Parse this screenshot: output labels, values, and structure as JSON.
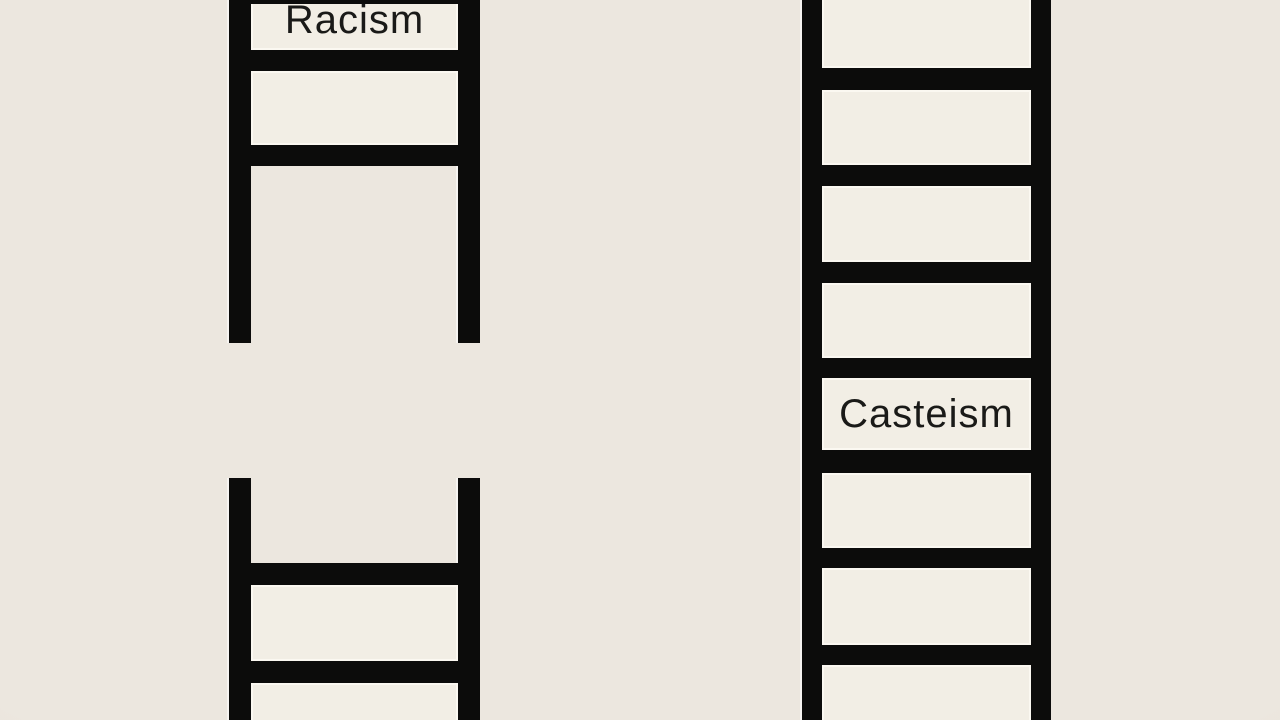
{
  "figure": {
    "type": "illustration",
    "background_color": "#ECE7DF",
    "ladder_color": "#0C0C0B",
    "cell_fill_color": "#F2EEE5",
    "cell_highlight_color": "#FBF8F1",
    "text_color": "#1A1A18"
  },
  "ladders": {
    "left": {
      "label": "Racism",
      "structure": "broken"
    },
    "right": {
      "label": "Casteism",
      "structure": "continuous"
    }
  }
}
